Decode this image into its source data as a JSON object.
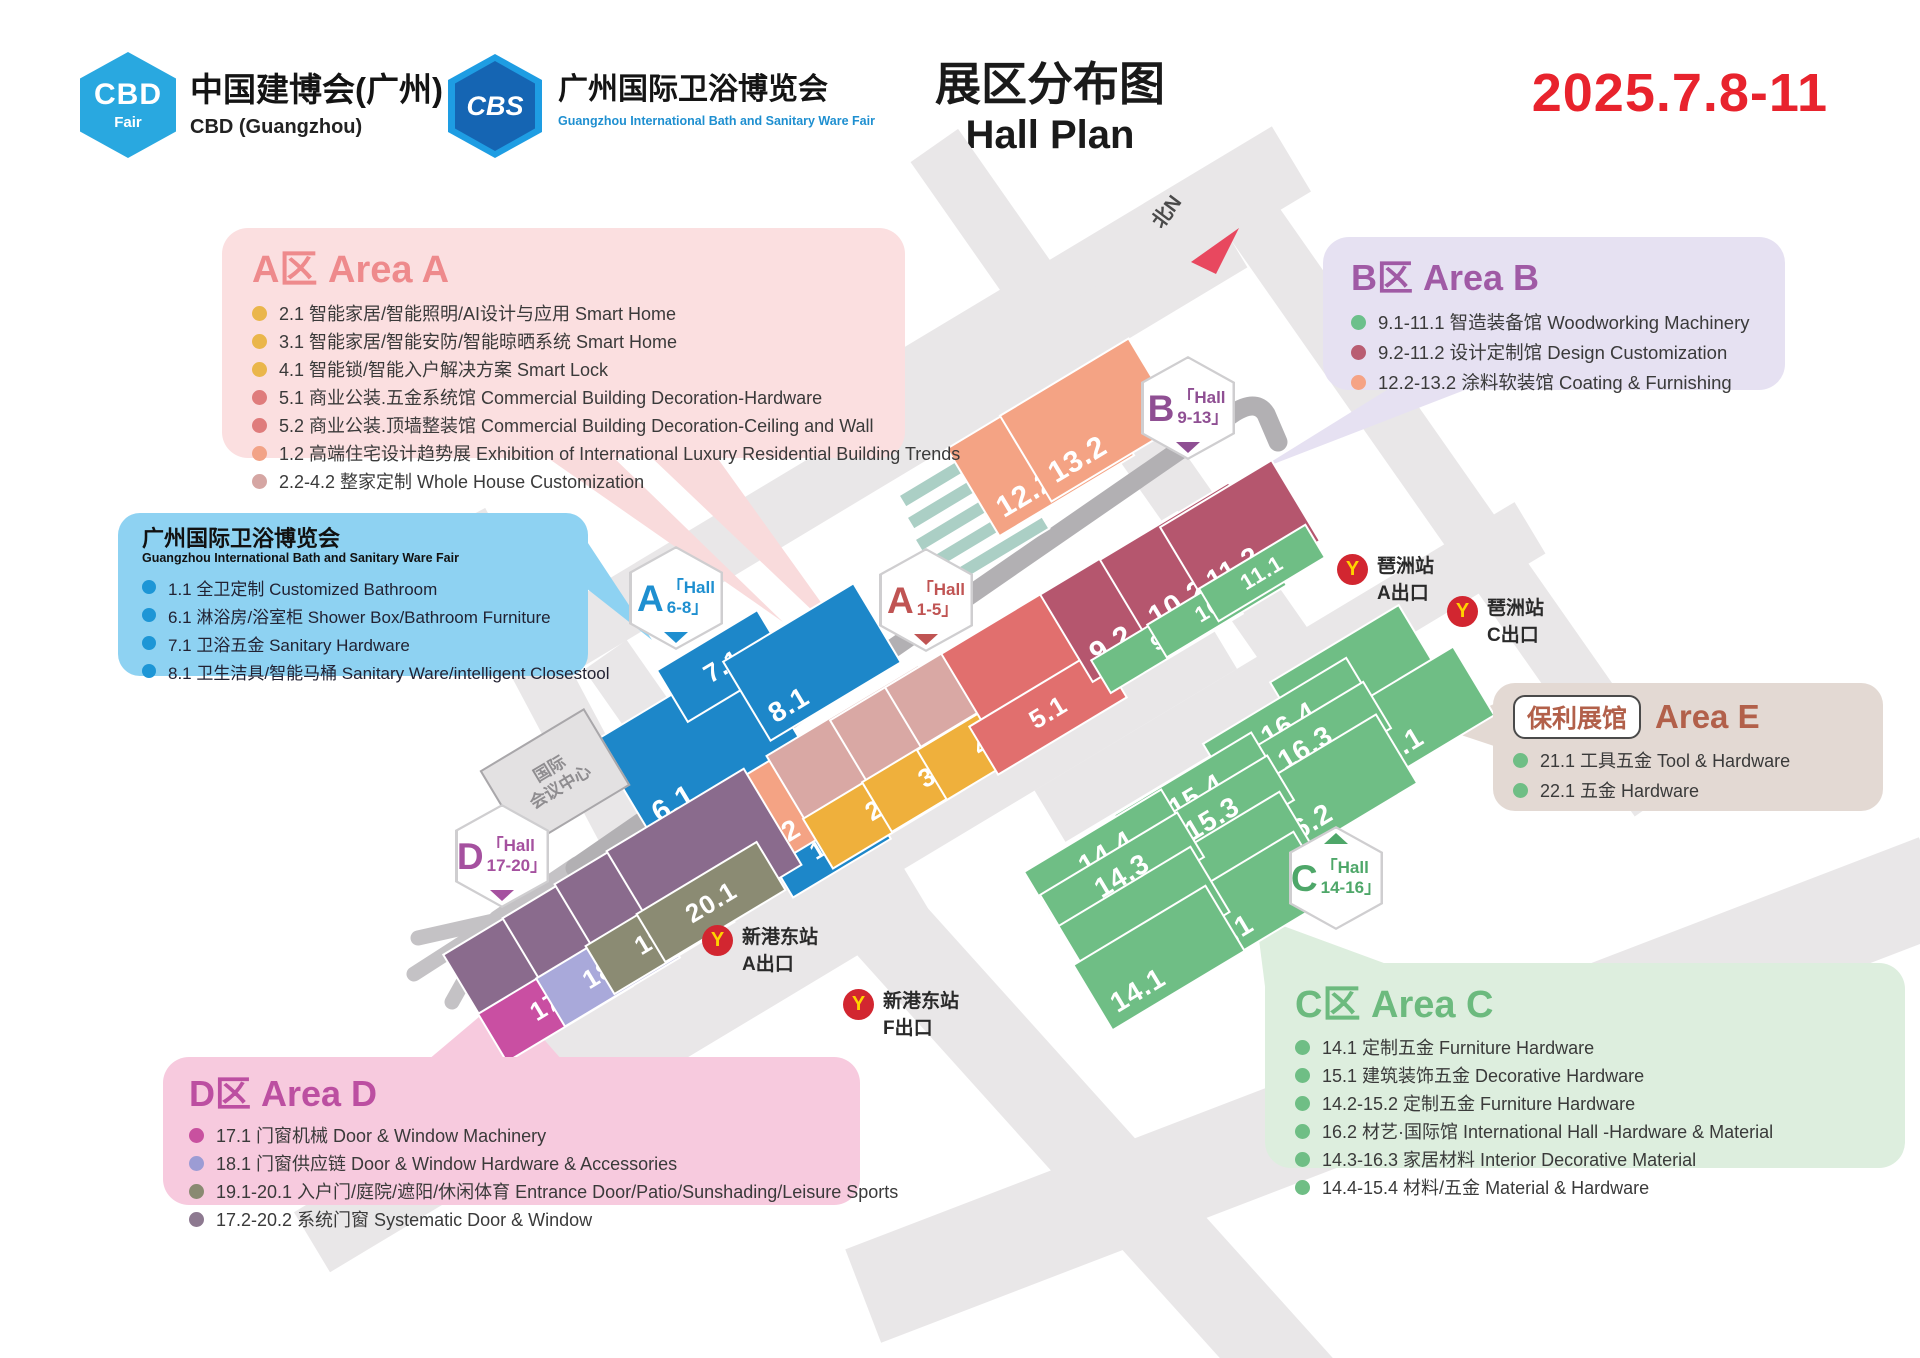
{
  "header": {
    "cbd": {
      "badge": "CBD",
      "badge_sub": "Fair",
      "title": "中国建博会(广州)",
      "subtitle": "CBD (Guangzhou)"
    },
    "cbs": {
      "badge": "CBS",
      "title": "广州国际卫浴博览会",
      "subtitle": "Guangzhou International Bath and Sanitary Ware Fair"
    },
    "title_cn": "展区分布图",
    "title_en": "Hall Plan",
    "date": "2025.7.8-11"
  },
  "legends": {
    "area_a": {
      "title": "A区 Area A",
      "items": [
        {
          "dot": "#eab64b",
          "text": "2.1 智能家居/智能照明/AI设计与应用 Smart Home"
        },
        {
          "dot": "#eab64b",
          "text": "3.1 智能家居/智能安防/智能晾晒系统 Smart Home"
        },
        {
          "dot": "#eab64b",
          "text": "4.1 智能锁/智能入户解决方案 Smart Lock"
        },
        {
          "dot": "#df7c7c",
          "text": "5.1 商业公装.五金系统馆 Commercial Building Decoration-Hardware"
        },
        {
          "dot": "#df7c7c",
          "text": "5.2 商业公装.顶墙整装馆 Commercial Building Decoration-Ceiling and Wall"
        },
        {
          "dot": "#f2a387",
          "text": "1.2 高端住宅设计趋势展 Exhibition of International Luxury Residential Building Trends"
        },
        {
          "dot": "#d5a6a3",
          "text": "2.2-4.2 整家定制 Whole House Customization"
        }
      ]
    },
    "bath": {
      "title": "广州国际卫浴博览会",
      "subtitle": "Guangzhou International Bath and Sanitary Ware Fair",
      "items": [
        {
          "dot": "#1d96d6",
          "text": "1.1 全卫定制 Customized Bathroom"
        },
        {
          "dot": "#1d96d6",
          "text": "6.1 淋浴房/浴室柜 Shower Box/Bathroom Furniture"
        },
        {
          "dot": "#1d96d6",
          "text": "7.1 卫浴五金 Sanitary Hardware"
        },
        {
          "dot": "#1d96d6",
          "text": "8.1 卫生洁具/智能马桶 Sanitary Ware/intelligent Closestool"
        }
      ]
    },
    "area_b": {
      "title": "B区 Area B",
      "items": [
        {
          "dot": "#6cc08b",
          "text": "9.1-11.1 智造装备馆 Woodworking Machinery"
        },
        {
          "dot": "#b95d72",
          "text": "9.2-11.2 设计定制馆 Design Customization"
        },
        {
          "dot": "#f5a385",
          "text": "12.2-13.2 涂料软装馆 Coating & Furnishing"
        }
      ]
    },
    "area_e": {
      "badge": "保利展馆",
      "title": "Area E",
      "items": [
        {
          "dot": "#6fbe85",
          "text": "21.1 工具五金 Tool & Hardware"
        },
        {
          "dot": "#6fbe85",
          "text": "22.1 五金 Hardware"
        }
      ]
    },
    "area_c": {
      "title": "C区 Area C",
      "items": [
        {
          "dot": "#6fbe85",
          "text": "14.1 定制五金 Furniture Hardware"
        },
        {
          "dot": "#6fbe85",
          "text": "15.1 建筑装饰五金 Decorative Hardware"
        },
        {
          "dot": "#6fbe85",
          "text": "14.2-15.2 定制五金 Furniture Hardware"
        },
        {
          "dot": "#6fbe85",
          "text": "16.2 材艺·国际馆 International Hall -Hardware & Material"
        },
        {
          "dot": "#6fbe85",
          "text": "14.3-16.3 家居材料 Interior Decorative Material"
        },
        {
          "dot": "#6fbe85",
          "text": "14.4-15.4 材料/五金 Material & Hardware"
        }
      ]
    },
    "area_d": {
      "title": "D区 Area D",
      "items": [
        {
          "dot": "#c8519f",
          "text": "17.1 门窗机械 Door & Window Machinery"
        },
        {
          "dot": "#9c9cd4",
          "text": "18.1 门窗供应链 Door & Window Hardware & Accessories"
        },
        {
          "dot": "#8a8a72",
          "text": "19.1-20.1 入户门/庭院/遮阳/休闲体育 Entrance Door/Patio/Sunshading/Leisure Sports"
        },
        {
          "dot": "#8d7990",
          "text": "17.2-20.2 系统门窗 Systematic Door & Window"
        }
      ]
    }
  },
  "map": {
    "palette": {
      "blue": "#1d87c9",
      "rose": "#d9a8a4",
      "red": "#e16f6e",
      "salmon": "#f4a384",
      "yellow": "#efb03c",
      "maroon": "#b5566e",
      "green": "#6fbe85",
      "mauve": "#8a6b8d",
      "magenta": "#c94fa2",
      "periwinkle": "#a9a9da",
      "olive": "#8b8b73"
    },
    "north_label": "北N",
    "conference_l1": "国际",
    "conference_l2": "会议中心",
    "hexagons": [
      {
        "id": "A68",
        "letter": "A",
        "hall": "「Hall",
        "range": "6-8」",
        "color": "#1e8fd0"
      },
      {
        "id": "A15",
        "letter": "A",
        "hall": "「Hall",
        "range": "1-5」",
        "color": "#c05453"
      },
      {
        "id": "B",
        "letter": "B",
        "hall": "「Hall",
        "range": "9-13」",
        "color": "#8f4f93"
      },
      {
        "id": "C",
        "letter": "C",
        "hall": "「Hall",
        "range": "14-16」",
        "color": "#4ea769"
      },
      {
        "id": "D",
        "letter": "D",
        "hall": "「Hall",
        "range": "17-20」",
        "color": "#a5519f"
      }
    ],
    "blocks": [
      {
        "id": "6.1",
        "color": "blue"
      },
      {
        "id": "7.1",
        "color": "blue"
      },
      {
        "id": "8.1",
        "color": "blue"
      },
      {
        "id": "1.1",
        "color": "blue"
      },
      {
        "id": "1.2",
        "color": "salmon"
      },
      {
        "id": "2.2",
        "color": "rose"
      },
      {
        "id": "3.2",
        "color": "rose"
      },
      {
        "id": "4.2",
        "color": "rose"
      },
      {
        "id": "2.1",
        "color": "yellow"
      },
      {
        "id": "3.1",
        "color": "yellow"
      },
      {
        "id": "4.1",
        "color": "yellow"
      },
      {
        "id": "5.2",
        "color": "red"
      },
      {
        "id": "5.1",
        "color": "red"
      },
      {
        "id": "12.2",
        "color": "salmon"
      },
      {
        "id": "13.2",
        "color": "salmon"
      },
      {
        "id": "9.2",
        "color": "maroon"
      },
      {
        "id": "10.2",
        "color": "maroon"
      },
      {
        "id": "11.2",
        "color": "maroon"
      },
      {
        "id": "9.1",
        "color": "green"
      },
      {
        "id": "10.1",
        "color": "green"
      },
      {
        "id": "11.1",
        "color": "green"
      },
      {
        "id": "21.1",
        "color": "green"
      },
      {
        "id": "22.1",
        "color": "green"
      },
      {
        "id": "16.4",
        "color": "green"
      },
      {
        "id": "16.3",
        "color": "green"
      },
      {
        "id": "16.2",
        "color": "green"
      },
      {
        "id": "15.4",
        "color": "green"
      },
      {
        "id": "15.3",
        "color": "green"
      },
      {
        "id": "15.2",
        "color": "green"
      },
      {
        "id": "15.1",
        "color": "green"
      },
      {
        "id": "14.4",
        "color": "green"
      },
      {
        "id": "14.3",
        "color": "green"
      },
      {
        "id": "14.2",
        "color": "green"
      },
      {
        "id": "14.1",
        "color": "green"
      },
      {
        "id": "17.2",
        "color": "mauve"
      },
      {
        "id": "18.2",
        "color": "mauve"
      },
      {
        "id": "19.2",
        "color": "mauve"
      },
      {
        "id": "20.2",
        "color": "mauve"
      },
      {
        "id": "17.1",
        "color": "magenta"
      },
      {
        "id": "18.1",
        "color": "periwinkle"
      },
      {
        "id": "19.1",
        "color": "olive"
      },
      {
        "id": "20.1",
        "color": "olive"
      }
    ],
    "stations": [
      {
        "name": "琶洲站",
        "exit": "A出口"
      },
      {
        "name": "琶洲站",
        "exit": "C出口"
      },
      {
        "name": "新港东站",
        "exit": "A出口"
      },
      {
        "name": "新港东站",
        "exit": "F出口"
      }
    ]
  }
}
